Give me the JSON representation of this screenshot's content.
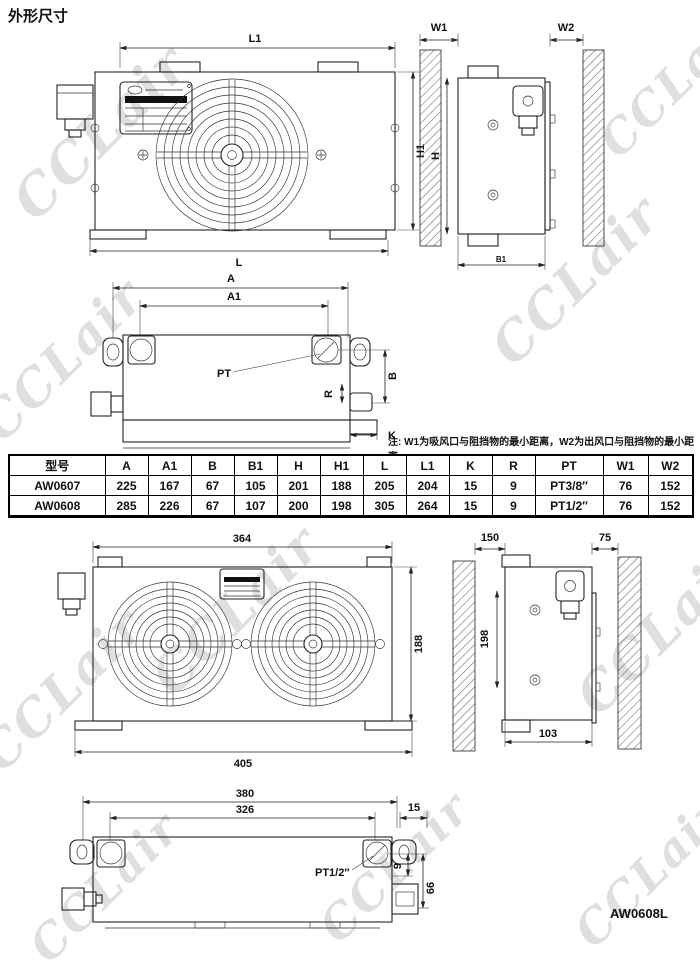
{
  "page": {
    "title": "外形尺寸",
    "watermark": "CCLair",
    "model_label": "AW0608L",
    "note": "注: W1为吸风口与阻挡物的最小距离，W2为出风口与阻挡物的最小距离."
  },
  "table": {
    "headers": [
      "型号",
      "A",
      "A1",
      "B",
      "B1",
      "H",
      "H1",
      "L",
      "L1",
      "K",
      "R",
      "PT",
      "W1",
      "W2"
    ],
    "rows": [
      [
        "AW0607",
        "225",
        "167",
        "67",
        "105",
        "201",
        "188",
        "205",
        "204",
        "15",
        "9",
        "PT3/8″",
        "76",
        "152"
      ],
      [
        "AW0608",
        "285",
        "226",
        "67",
        "107",
        "200",
        "198",
        "305",
        "264",
        "15",
        "9",
        "PT1/2″",
        "76",
        "152"
      ]
    ]
  },
  "drawings": {
    "aw0607_front": {
      "dim_top": "L1",
      "dim_right": "H1",
      "dim_bottom": "L"
    },
    "aw0607_side": {
      "dim_left_clearance": "W1",
      "dim_right_clearance": "W2",
      "dim_height": "H",
      "dim_depth": "B1"
    },
    "aw0607_top": {
      "dim_a": "A",
      "dim_a1": "A1",
      "port_label": "PT",
      "dim_b": "B",
      "dim_r": "R",
      "dim_k": "K"
    },
    "aw0608l_front": {
      "dim_top": "364",
      "dim_right": "188",
      "dim_bottom": "405"
    },
    "aw0608l_side": {
      "dim_left_clearance": "150",
      "dim_right_clearance": "75",
      "dim_height": "198",
      "dim_bottom": "103"
    },
    "aw0608l_bottom": {
      "dim_top": "380",
      "dim_inner": "326",
      "dim_offset": "15",
      "port_label": "PT1/2″",
      "dim_port_offset": "9",
      "dim_outlet": "66"
    }
  }
}
